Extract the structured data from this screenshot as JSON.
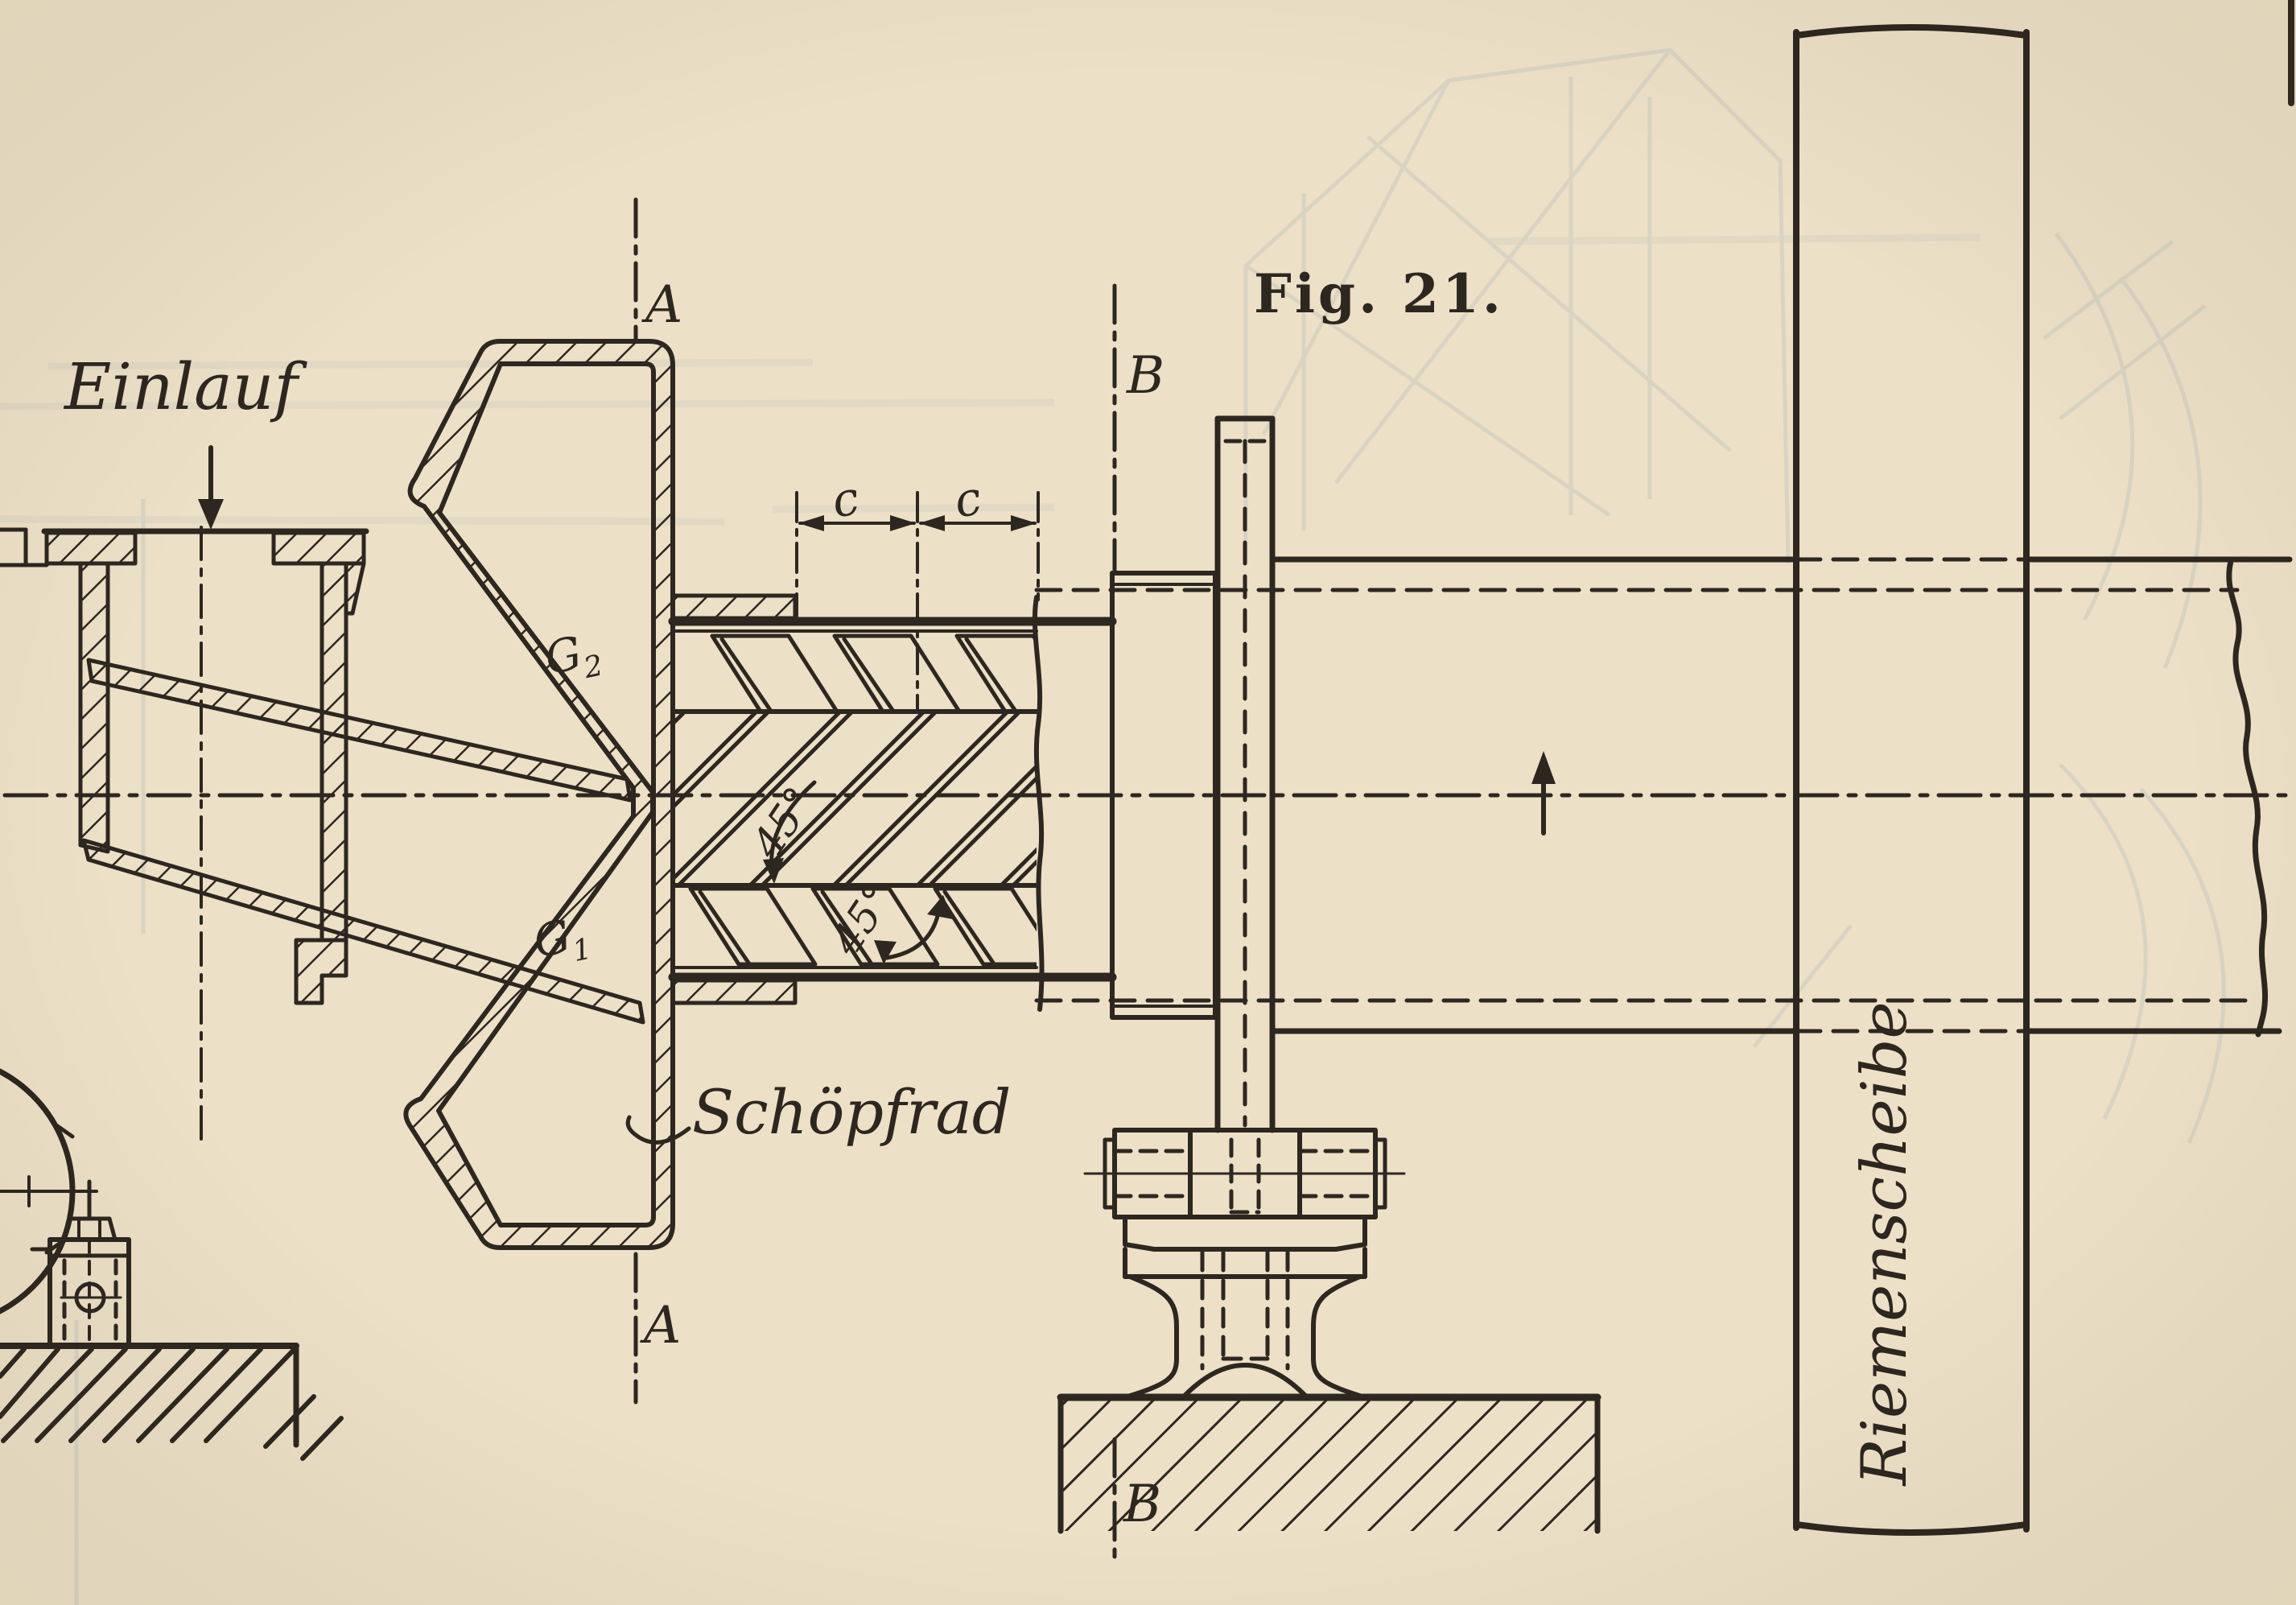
{
  "figure_caption": "Fig. 21.",
  "annotations": {
    "einlauf": "Einlauf",
    "schoepfrad": "Schöpfrad",
    "riemenscheibe": "Riemenscheibe",
    "section_a": "A",
    "section_b": "B",
    "g2": {
      "base": "G",
      "sub": "2"
    },
    "g1": {
      "base": "G",
      "sub": "1"
    },
    "dim_c_left": "c",
    "dim_c_right": "c",
    "angle_top": "45°",
    "angle_bottom": "45°"
  },
  "colors": {
    "paper": "#ece0c6",
    "ink": "#2d2721",
    "ghost": "#93a7b5"
  }
}
